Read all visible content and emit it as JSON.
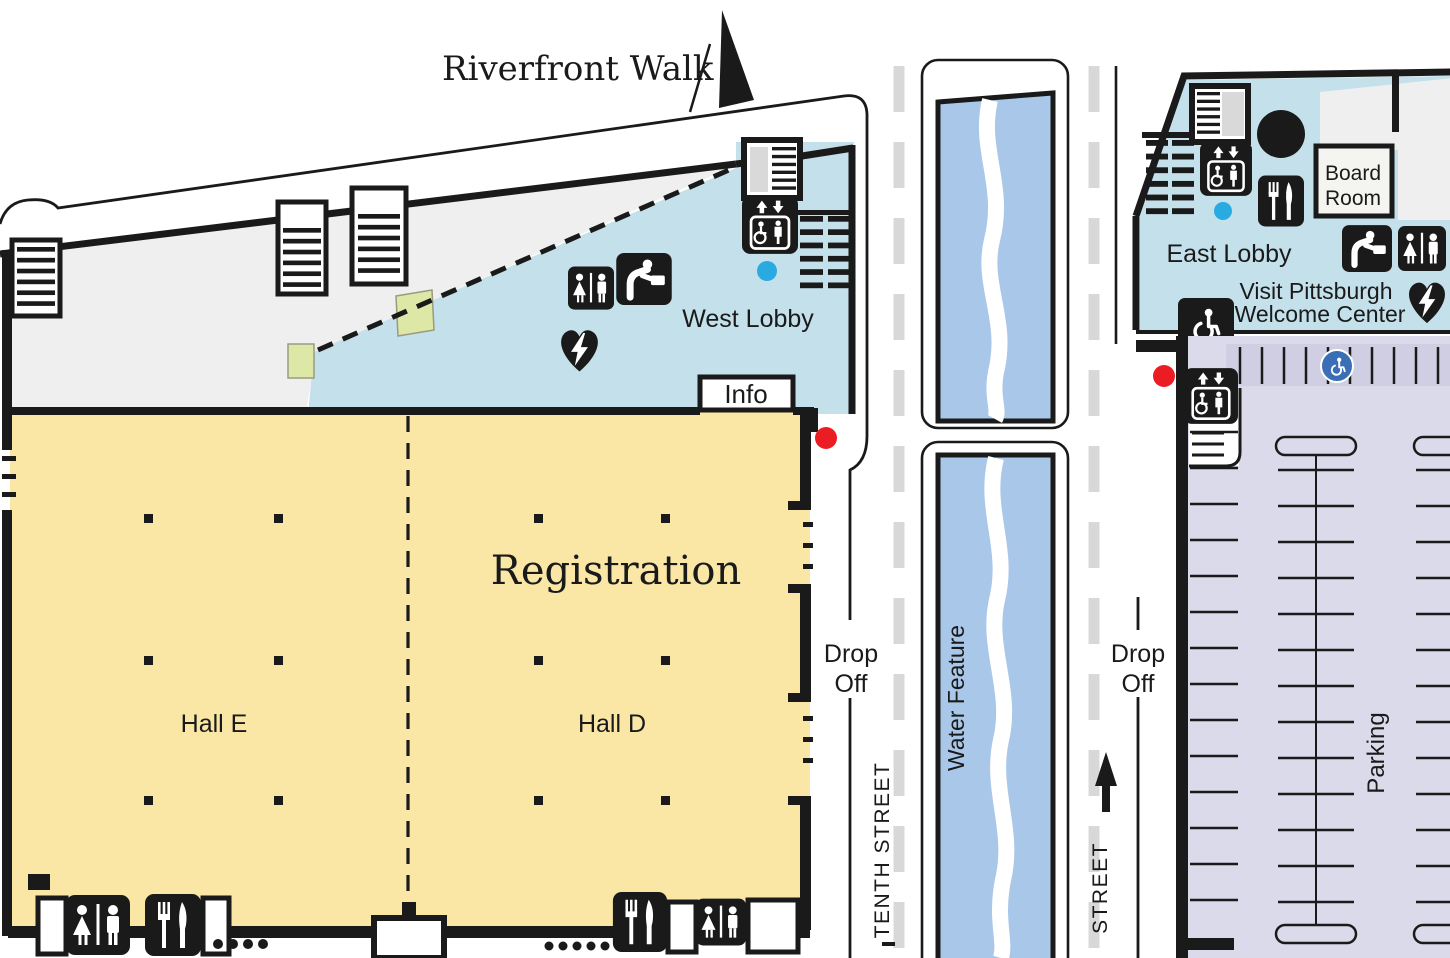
{
  "title": {
    "riverfront_walk": "Riverfront Walk"
  },
  "west_building": {
    "west_lobby": "West Lobby",
    "info": "Info",
    "registration": "Registration",
    "hall_e": "Hall E",
    "hall_d": "Hall D"
  },
  "streets": {
    "drop_off_line1": "Drop",
    "drop_off_line2": "Off",
    "tenth_street": "TENTH STREET",
    "water_feature": "Water Feature",
    "east_street": "STREET"
  },
  "east_building": {
    "east_lobby": "East Lobby",
    "board_room_line1": "Board",
    "board_room_line2": "Room",
    "welcome_center_line1": "Visit Pittsburgh",
    "welcome_center_line2": "Welcome Center",
    "parking": "Parking",
    "atm_symbol": "$"
  },
  "icons": [
    "north-arrow-icon",
    "stairs-icon",
    "escalator-icon",
    "elevator-icon",
    "restroom-icon",
    "drinking-fountain-icon",
    "aed-icon",
    "atm-icon",
    "food-icon",
    "accessible-icon",
    "accessible-parking-icon",
    "entrance-marker-dot",
    "elevator-marker-dot"
  ],
  "colors": {
    "hall_yellow": "#FAE7A6",
    "lobby_blue": "#C3E0EB",
    "water_blue": "#A9C7E9",
    "parking_lavender": "#DBDAEA",
    "parking_band": "#CFCEE2",
    "concourse_gray": "#EFEFEF",
    "room_green": "#DDE8A6",
    "wall_black": "#1A1A1A",
    "entrance_red": "#EC1C24",
    "elevator_cyan": "#29ABE2",
    "street_dash_gray": "#D8D8D8",
    "accessible_blue": "#3A6FB5"
  }
}
